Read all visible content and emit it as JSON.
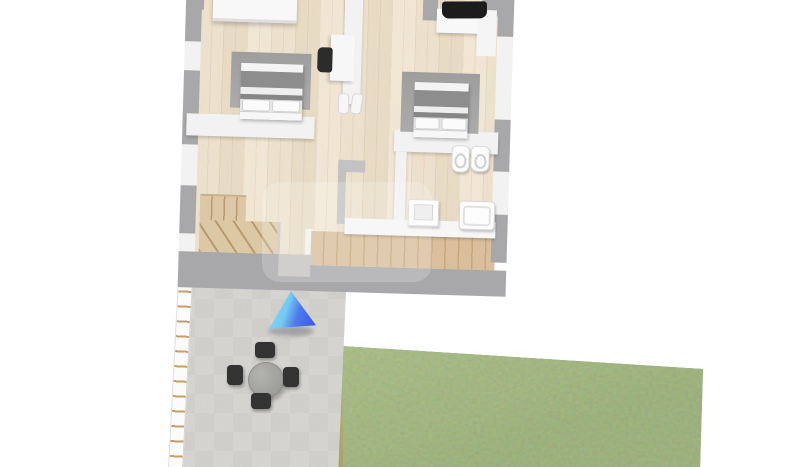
{
  "meta": {
    "description": "3D rendered top-down floor plan of an upper storey with furnished rooms, stone patio and lawn",
    "canvas_width": 800,
    "canvas_height": 467
  },
  "colors": {
    "background": "#ffffff",
    "wall_top": "#a8a8aa",
    "wall_face": "#f2f2f2",
    "floor_wood": "#e9dcc7",
    "floor_line": "#dbc9ad",
    "deck_wood": "#d9bf9b",
    "deck_line": "#c7a87c",
    "stair_wood": "#ddc8a6",
    "stair_line": "#b79a72",
    "rug": "#a4a4a4",
    "duvet": "#8d8d8d",
    "linen": "#f4f4f4",
    "paver": "#c9c7c3",
    "paver_alt": "#bfbdb9",
    "grass": "#7f9a5b",
    "grass_shade": "#6d8a4c",
    "marker_light": "#93dbf7",
    "marker_dark": "#3b50e2",
    "fence_rung": "#c79e67",
    "table_top": "#a6a6a2",
    "chair_dark": "#333333"
  },
  "house": {
    "rooms": [
      "bedroom-left",
      "bedroom-right",
      "bathroom",
      "hallway",
      "staircase",
      "wood-deck"
    ],
    "furniture": [
      "wardrobe",
      "double-bed-left",
      "double-bed-right",
      "desk-with-chair",
      "desk-with-monitor",
      "slippers",
      "toilet",
      "bidet",
      "washbasin",
      "bathtub"
    ]
  },
  "exterior": {
    "areas": [
      "stone-patio",
      "lawn",
      "fence"
    ],
    "patio_furniture": "round-table-with-four-chairs",
    "camera_marker": "blue-view-cone"
  }
}
